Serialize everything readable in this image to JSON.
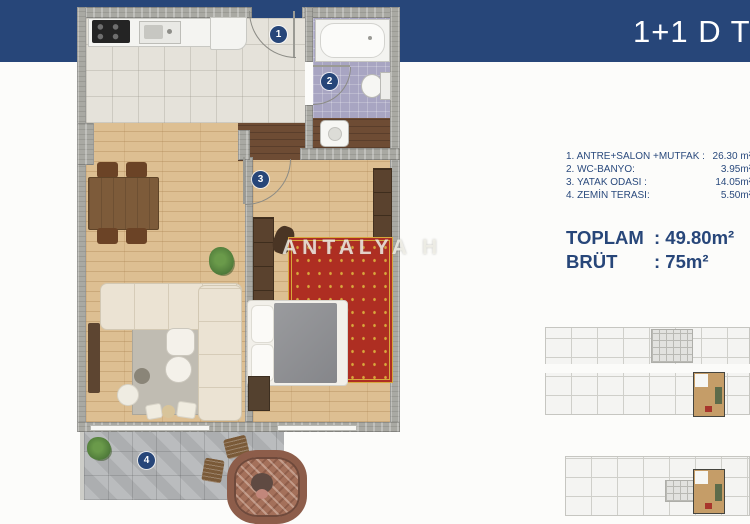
{
  "header": {
    "title": "1+1 D T"
  },
  "legend": {
    "rooms": [
      {
        "label": "1. ANTRE+SALON +MUTFAK :",
        "value": "26.30 m²"
      },
      {
        "label": "2. WC-BANYO:",
        "value": "3.95m²"
      },
      {
        "label": "3. YATAK ODASI :",
        "value": "14.05m²"
      },
      {
        "label": "4. ZEMİN TERASI:",
        "value": "5.50m²"
      }
    ],
    "totals": [
      {
        "label": "TOPLAM",
        "value": ": 49.80m²"
      },
      {
        "label": "BRÜT",
        "value": ": 75m²"
      }
    ]
  },
  "plan": {
    "markers": [
      "1",
      "2",
      "3",
      "4"
    ],
    "watermark": "ANTALYA H"
  },
  "colors": {
    "accent_navy": "#274679",
    "wall_gray": "#A9A9A3",
    "wood_floor": "#DDBF92",
    "bath_tile": "#A8A5C2",
    "rug_red": "#B03226",
    "keyplan_highlight": "#C59D68"
  }
}
